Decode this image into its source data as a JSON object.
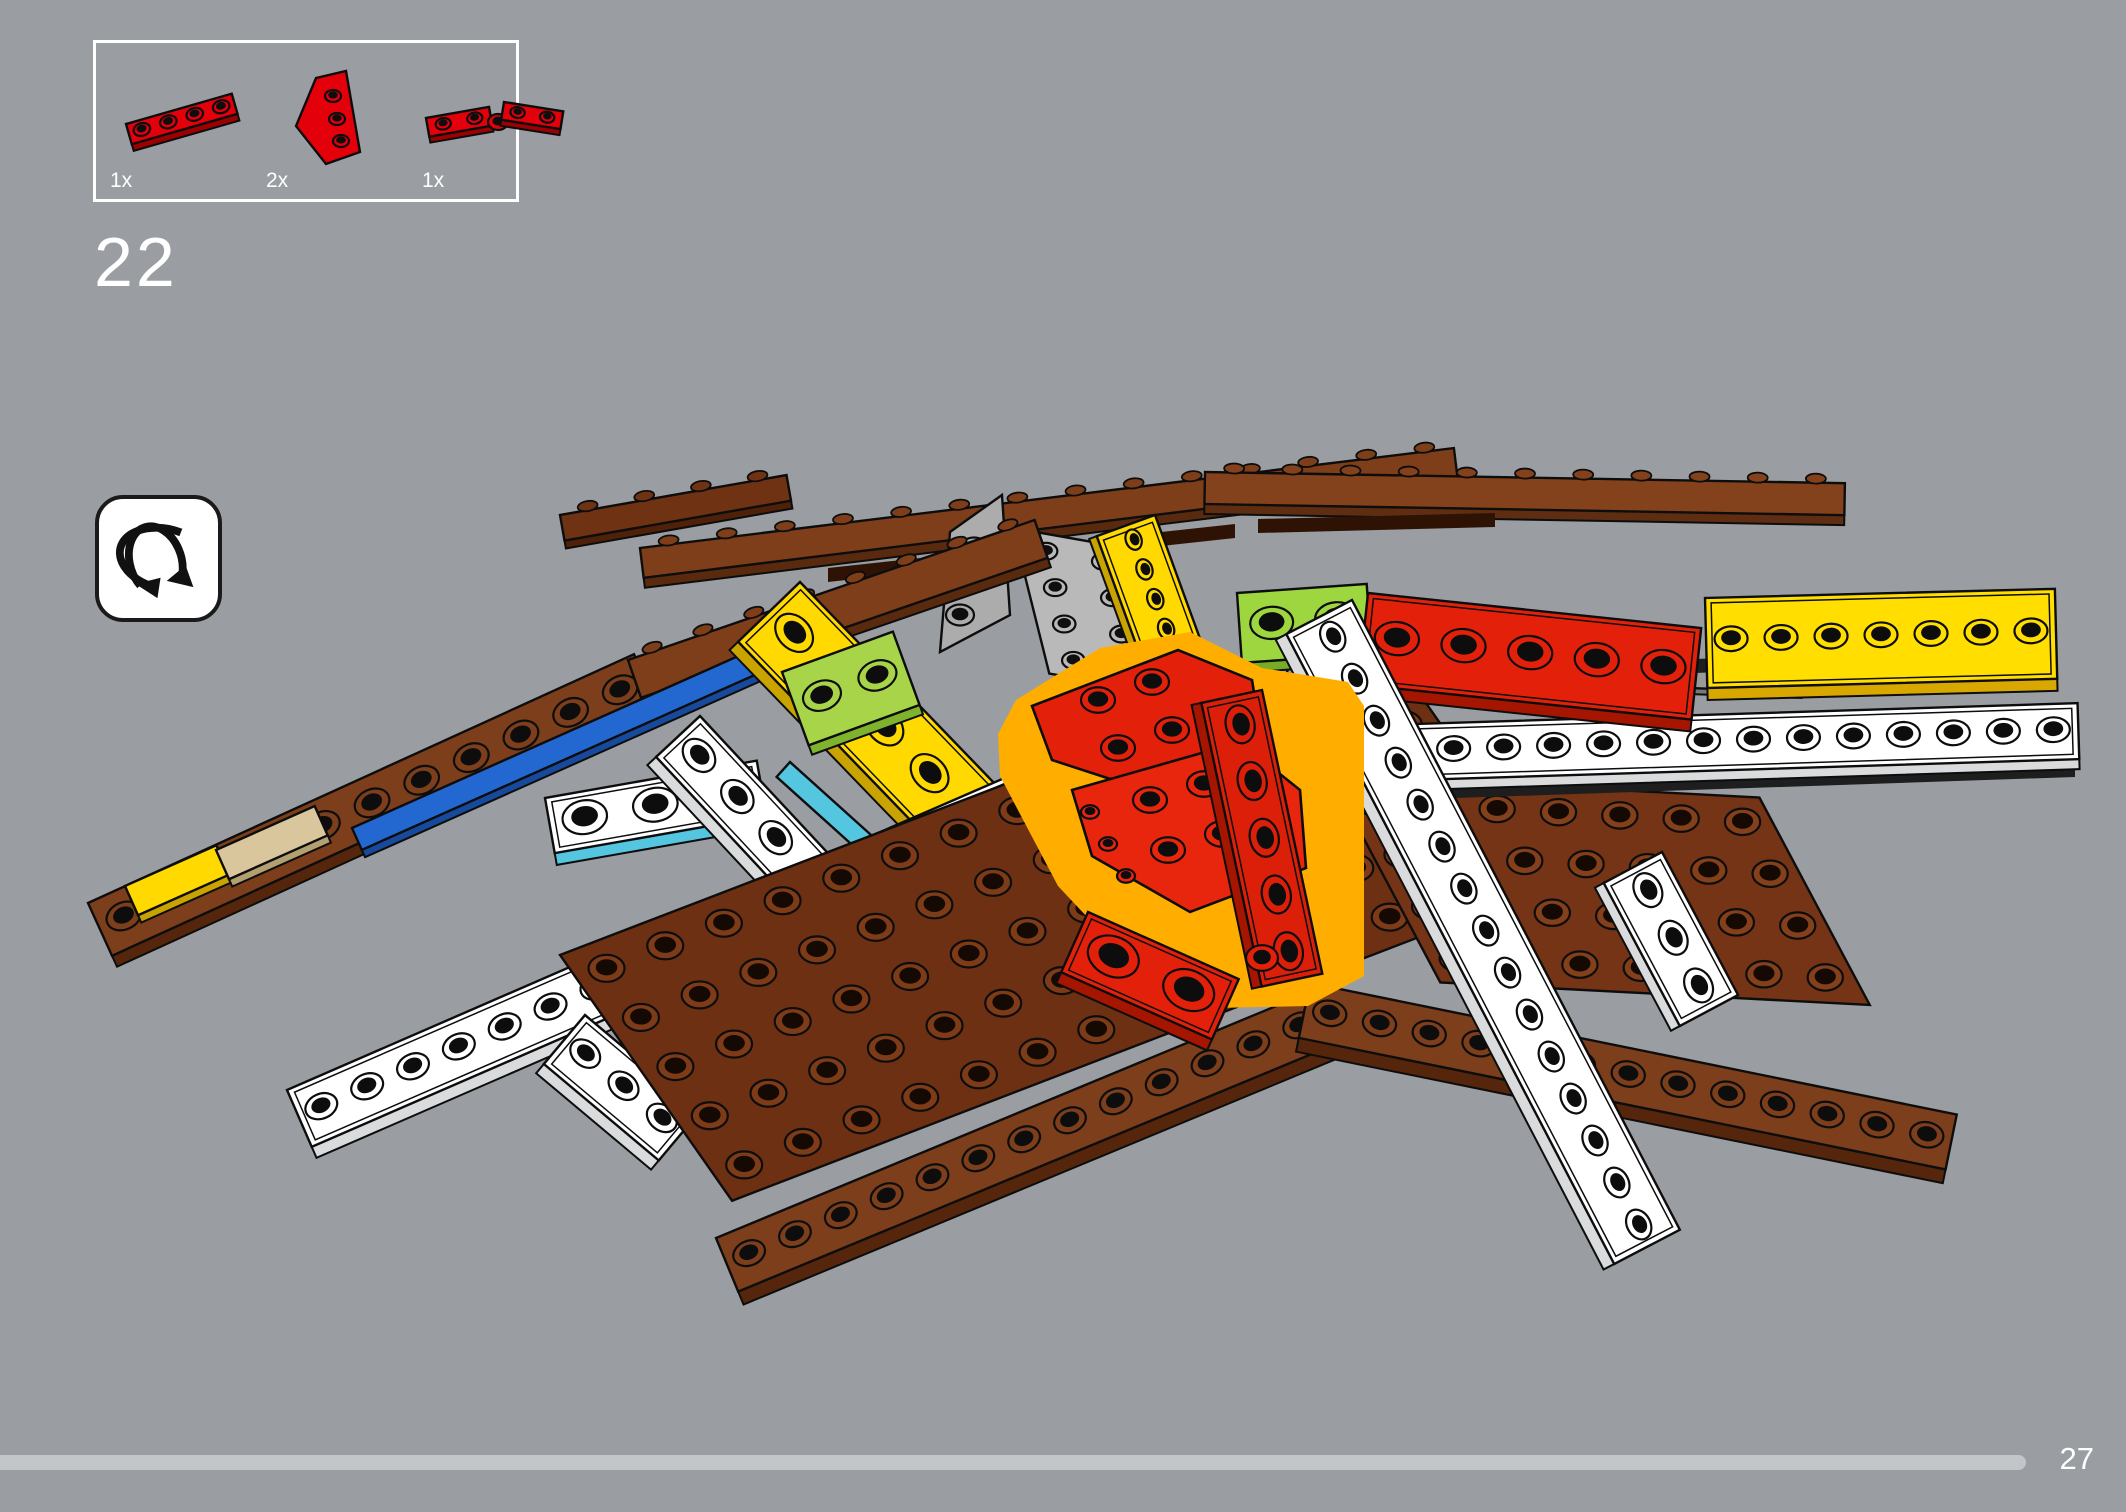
{
  "page": {
    "background": "#9A9EA2"
  },
  "parts_panel": {
    "border_color": "#FFFFFF",
    "parts": [
      {
        "name": "red-plate-1x4",
        "qty": "1x",
        "drawing": [
          {
            "t": "bar",
            "x": 16,
            "y": 58,
            "a": -16,
            "L": 110,
            "W": 21,
            "sh": 9,
            "top": "#E3000B",
            "side": "#9C0000",
            "n": 4
          }
        ]
      },
      {
        "name": "red-wedge-plate",
        "qty": "2x",
        "drawing": [
          {
            "t": "poly",
            "pts": [
              [
                50,
                12
              ],
              [
                80,
                5
              ],
              [
                94,
                86
              ],
              [
                60,
                98
              ],
              [
                30,
                60
              ]
            ],
            "fill": "#E3000B",
            "stroke": "#0D0D0D",
            "sw": 2.4,
            "studs": [
              [
                67,
                30,
                8
              ],
              [
                71,
                53,
                8
              ],
              [
                75,
                75,
                8
              ]
            ],
            "sf": "#E3000B"
          }
        ]
      },
      {
        "name": "red-hinge-plate",
        "qty": "1x",
        "drawing": [
          {
            "t": "bar",
            "x": 4,
            "y": 52,
            "a": -10,
            "L": 64,
            "W": 19,
            "sh": 8,
            "top": "#E3000B",
            "side": "#9C0000",
            "n": 2
          },
          {
            "t": "disc",
            "x": 76,
            "y": 56,
            "r": 10,
            "fill": "#E3000B"
          },
          {
            "t": "bar",
            "x": 82,
            "y": 36,
            "a": 9,
            "L": 60,
            "W": 18,
            "sh": 8,
            "top": "#E3000B",
            "side": "#9C0000",
            "n": 2
          }
        ]
      }
    ]
  },
  "step": {
    "number": "22"
  },
  "rotate_hint": {
    "icon": "rotate-model-icon",
    "bg": "#FFFFFF",
    "glyph_color": "#111111"
  },
  "footer": {
    "page_number": "27",
    "progress_percent": 95.3,
    "track_color": "#C2C6C9"
  },
  "highlight_color": "#FFAE00",
  "illustration": {
    "pieces": [
      {
        "t": "rail",
        "x": 560,
        "y": 515,
        "a": -10,
        "L": 230,
        "W": 26,
        "sh": 10,
        "top": "#6F3314",
        "side": "#4F2108",
        "n": 4
      },
      {
        "t": "rail",
        "x": 640,
        "y": 548,
        "a": -7,
        "L": 820,
        "W": 30,
        "sh": 12,
        "top": "#7E3E1A",
        "side": "#5A2A0E",
        "n": 14
      },
      {
        "t": "rail",
        "x": 1205,
        "y": 472,
        "a": 1,
        "L": 640,
        "W": 32,
        "sh": 12,
        "top": "#84421C",
        "side": "#5E2D12",
        "n": 11
      },
      {
        "t": "poly",
        "pts": [
          [
            828,
            568
          ],
          [
            1235,
            524
          ],
          [
            1235,
            538
          ],
          [
            828,
            582
          ]
        ],
        "fill": "#2E1305"
      },
      {
        "t": "poly",
        "pts": [
          [
            1258,
            519
          ],
          [
            1495,
            513
          ],
          [
            1495,
            527
          ],
          [
            1258,
            533
          ]
        ],
        "fill": "#2E1305"
      },
      {
        "t": "poly",
        "pts": [
          [
            950,
            532
          ],
          [
            1002,
            495
          ],
          [
            1010,
            615
          ],
          [
            940,
            652
          ]
        ],
        "fill": "#ACACAC",
        "stroke": "#0D0D0D",
        "sw": 2.4,
        "studs": [
          [
            974,
            548,
            14
          ],
          [
            967,
            583,
            14
          ],
          [
            960,
            615,
            14
          ]
        ],
        "sf": "#ACACAC",
        "hole": "#0F0F0F"
      },
      {
        "t": "grid",
        "x": 1013,
        "y": 528,
        "ua": 10,
        "ul": 116,
        "un": 2,
        "va": 76,
        "vl": 150,
        "vn": 4,
        "fill": "#B9B9B9",
        "sf": "#B9B9B9",
        "hole": "#0F0F0F"
      },
      {
        "t": "bar",
        "x": 1155,
        "y": 515,
        "a": 70,
        "L": 190,
        "W": 62,
        "sh": 10,
        "top": "#FFD900",
        "side": "#C9A300",
        "n": 6,
        "rim": true
      },
      {
        "t": "bar",
        "x": 88,
        "y": 903,
        "a": -24.5,
        "L": 600,
        "W": 58,
        "sh": 14,
        "top": "#7C3E1B",
        "side": "#55260C",
        "n": 11
      },
      {
        "t": "rail",
        "x": 628,
        "y": 660,
        "a": -19,
        "L": 430,
        "W": 40,
        "sh": 12,
        "top": "#7E3E1A",
        "side": "#5A2A0E",
        "n": 8
      },
      {
        "t": "bar",
        "x": 125,
        "y": 886,
        "a": -24,
        "L": 100,
        "W": 32,
        "sh": 10,
        "top": "#FFD900",
        "side": "#C9A300",
        "n": 0
      },
      {
        "t": "bar",
        "x": 216,
        "y": 850,
        "a": -24,
        "L": 108,
        "W": 32,
        "sh": 10,
        "top": "#DAC69C",
        "side": "#B3A071",
        "n": 0
      },
      {
        "t": "bar",
        "x": 352,
        "y": 828,
        "a": -24,
        "L": 470,
        "W": 24,
        "sh": 10,
        "top": "#2368D0",
        "side": "#17499C",
        "n": 0
      },
      {
        "t": "bar",
        "x": 795,
        "y": 600,
        "a": 52,
        "L": 70,
        "W": 22,
        "sh": 8,
        "top": "#2368D0",
        "n": 0
      },
      {
        "t": "bar",
        "x": 836,
        "y": 650,
        "a": 52,
        "L": 30,
        "W": 20,
        "sh": 8,
        "top": "#D6210F",
        "n": 0
      },
      {
        "t": "bar",
        "x": 800,
        "y": 582,
        "a": 46,
        "L": 390,
        "W": 86,
        "sh": 14,
        "top": "#FFD900",
        "side": "#C9A300",
        "n": 6,
        "rim": true
      },
      {
        "t": "bar",
        "x": 790,
        "y": 762,
        "a": 42,
        "L": 120,
        "W": 20,
        "sh": 8,
        "top": "#55C6DF",
        "n": 0
      },
      {
        "t": "bar",
        "x": 782,
        "y": 672,
        "a": -20,
        "L": 118,
        "W": 78,
        "sh": 12,
        "top": "#A8D44A",
        "side": "#7FB32E",
        "n": 2
      },
      {
        "t": "bar",
        "x": 545,
        "y": 798,
        "a": -10,
        "L": 215,
        "W": 56,
        "sh": 14,
        "top": "#FFFFFF",
        "side": "#55C6DF",
        "n": 3,
        "rim": true
      },
      {
        "t": "bar",
        "x": 287,
        "y": 1090,
        "a": -23.5,
        "L": 800,
        "W": 62,
        "sh": 14,
        "top": "#FFFFFF",
        "side": "#D9DBDD",
        "n": 16,
        "rim": true
      },
      {
        "t": "bar",
        "x": 700,
        "y": 716,
        "a": 47,
        "L": 450,
        "W": 60,
        "sh": 14,
        "top": "#FFFFFF",
        "side": "#D9DBDD",
        "n": 8,
        "rim": true
      },
      {
        "t": "bar",
        "x": 585,
        "y": 1015,
        "a": 40,
        "L": 150,
        "W": 64,
        "sh": 14,
        "top": "#FFFFFF",
        "side": "#D9DBDD",
        "n": 3,
        "rim": true
      },
      {
        "t": "grid",
        "x": 560,
        "y": 955,
        "ua": -21,
        "ul": 880,
        "un": 14,
        "va": 55,
        "vl": 300,
        "vn": 5,
        "fill": "#6E3013",
        "sf": "#7E3B17",
        "hole": "#150903"
      },
      {
        "t": "grid",
        "x": 1330,
        "y": 775,
        "ua": 3,
        "ul": 430,
        "un": 7,
        "va": 62,
        "vl": 235,
        "vn": 4,
        "fill": "#743415",
        "sf": "#83401A",
        "hole": "#150903"
      },
      {
        "t": "bar",
        "x": 716,
        "y": 1238,
        "a": -22.5,
        "L": 645,
        "W": 58,
        "sh": 16,
        "top": "#7C3E1B",
        "side": "#55260C",
        "n": 13
      },
      {
        "t": "bar",
        "x": 1310,
        "y": 983,
        "a": 11.5,
        "L": 660,
        "W": 56,
        "sh": 16,
        "top": "#7C3E1B",
        "side": "#55260C",
        "n": 13
      },
      {
        "t": "poly",
        "pts": [
          [
            1132,
            795
          ],
          [
            2075,
            763
          ],
          [
            2075,
            777
          ],
          [
            1132,
            809
          ]
        ],
        "fill": "#1E1E1E"
      },
      {
        "t": "bar",
        "x": 1128,
        "y": 733,
        "a": -1.8,
        "L": 950,
        "W": 56,
        "sh": 12,
        "top": "#FFFFFF",
        "side": "#D9DBDD",
        "n": 19,
        "rim": true
      },
      {
        "t": "bar",
        "x": 1288,
        "y": 650,
        "a": 2,
        "L": 515,
        "W": 24,
        "sh": 8,
        "top": "#9A9A9A",
        "side": "#787878",
        "n": 0
      },
      {
        "t": "poly",
        "pts": [
          [
            1292,
            674
          ],
          [
            2042,
            646
          ],
          [
            2042,
            660
          ],
          [
            1292,
            688
          ]
        ],
        "fill": "#1E1E1E"
      },
      {
        "t": "bar",
        "x": 1237,
        "y": 593,
        "a": -4,
        "L": 130,
        "W": 70,
        "sh": 12,
        "top": "#9ED63F",
        "side": "#76AC26",
        "n": 2
      },
      {
        "t": "bar",
        "x": 1305,
        "y": 662,
        "a": 40,
        "L": 60,
        "W": 18,
        "sh": 6,
        "top": "#55C6DF",
        "n": 0
      },
      {
        "t": "bar",
        "x": 1368,
        "y": 593,
        "a": 6,
        "L": 335,
        "W": 92,
        "sh": 14,
        "top": "#E3210B",
        "side": "#A51500",
        "n": 5,
        "rim": true
      },
      {
        "t": "bar",
        "x": 1705,
        "y": 598,
        "a": -1.5,
        "L": 350,
        "W": 90,
        "sh": 14,
        "top": "#FFDE00",
        "side": "#D9A800",
        "n": 7,
        "rim": true
      },
      {
        "t": "bar",
        "x": 1352,
        "y": 600,
        "a": 62.5,
        "L": 710,
        "W": 74,
        "sh": 14,
        "top": "#FFFFFF",
        "side": "#D9DBDD",
        "n": 15,
        "rim": true
      },
      {
        "t": "bar",
        "x": 1662,
        "y": 852,
        "a": 62,
        "L": 162,
        "W": 66,
        "sh": 12,
        "top": "#FFFFFF",
        "side": "#D9DBDD",
        "n": 3,
        "rim": true
      },
      {
        "t": "poly",
        "pts": [
          [
            1016,
            700
          ],
          [
            1100,
            648
          ],
          [
            1190,
            632
          ],
          [
            1262,
            668
          ],
          [
            1348,
            682
          ],
          [
            1364,
            706
          ],
          [
            1364,
            976
          ],
          [
            1308,
            1006
          ],
          [
            1216,
            1008
          ],
          [
            1120,
            952
          ],
          [
            1058,
            886
          ],
          [
            1000,
            776
          ],
          [
            998,
            734
          ]
        ],
        "fill": "#FFAE00"
      },
      {
        "t": "poly",
        "pts": [
          [
            1032,
            706
          ],
          [
            1178,
            650
          ],
          [
            1252,
            680
          ],
          [
            1262,
            740
          ],
          [
            1150,
            792
          ],
          [
            1052,
            760
          ]
        ],
        "fill": "#E3210B",
        "stroke": "#0D0D0D",
        "sw": 2.6,
        "studs": [
          [
            1098,
            700,
            17
          ],
          [
            1152,
            682,
            17
          ],
          [
            1118,
            748,
            17
          ],
          [
            1172,
            730,
            17
          ]
        ],
        "sf": "#E3210B"
      },
      {
        "t": "poly",
        "pts": [
          [
            1072,
            790
          ],
          [
            1240,
            742
          ],
          [
            1300,
            790
          ],
          [
            1306,
            868
          ],
          [
            1190,
            912
          ],
          [
            1092,
            856
          ]
        ],
        "fill": "#E8260D",
        "stroke": "#0D0D0D",
        "sw": 2.6,
        "studs": [
          [
            1150,
            800,
            17
          ],
          [
            1204,
            784,
            17
          ],
          [
            1168,
            850,
            17
          ],
          [
            1222,
            834,
            17
          ],
          [
            1090,
            812,
            9
          ],
          [
            1108,
            844,
            9
          ],
          [
            1126,
            876,
            9
          ]
        ],
        "sf": "#E8260D"
      },
      {
        "t": "bar",
        "x": 1262,
        "y": 690,
        "a": 78,
        "L": 290,
        "W": 62,
        "sh": 12,
        "top": "#DC1F09",
        "side": "#A51500",
        "n": 5,
        "rim": true
      },
      {
        "t": "bar",
        "x": 1088,
        "y": 912,
        "a": 24,
        "L": 165,
        "W": 66,
        "sh": 14,
        "top": "#E3210B",
        "side": "#A51500",
        "n": 2,
        "rim": true
      },
      {
        "t": "disc",
        "x": 1262,
        "y": 958,
        "r": 16,
        "fill": "#E3210B"
      }
    ]
  }
}
